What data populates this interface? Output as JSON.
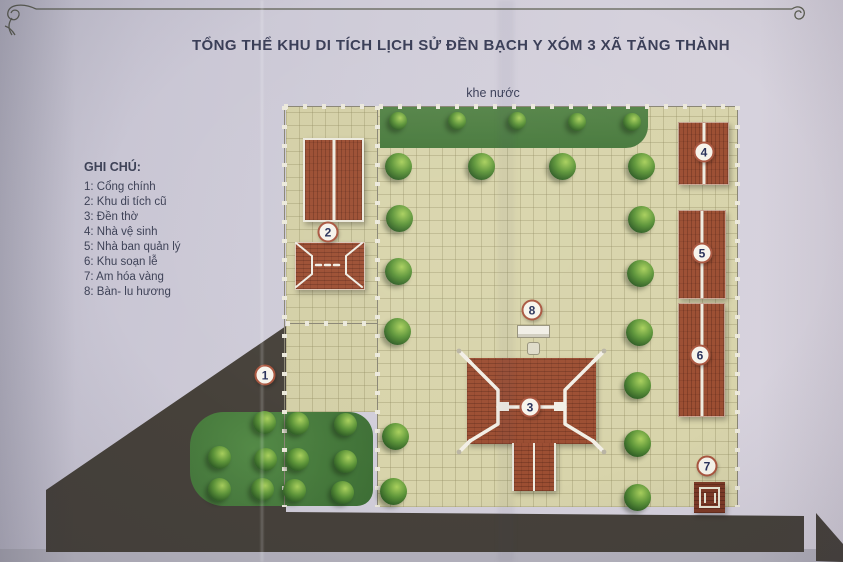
{
  "title": "TỔNG THỂ KHU DI TÍCH LỊCH SỬ ĐỀN BẠCH Y XÓM 3 XÃ TĂNG THÀNH",
  "water_label": "khe nước",
  "legend": {
    "heading": "GHI CHÚ:",
    "items": [
      {
        "num": "1",
        "text": "1: Cổng chính"
      },
      {
        "num": "2",
        "text": "2: Khu di tích cũ"
      },
      {
        "num": "3",
        "text": "3: Đền thờ"
      },
      {
        "num": "4",
        "text": "4: Nhà vệ sinh"
      },
      {
        "num": "5",
        "text": "5: Nhà ban quản lý"
      },
      {
        "num": "6",
        "text": "6: Khu soạn lễ"
      },
      {
        "num": "7",
        "text": "7: Am hóa vàng"
      },
      {
        "num": "8",
        "text": "8: Bàn- lu hương"
      }
    ]
  },
  "markers": [
    "1",
    "2",
    "3",
    "4",
    "5",
    "6",
    "7",
    "8"
  ],
  "colors": {
    "paper": "#cfccd8",
    "courtyard_tile": "#d8d4ab",
    "grass": "#4a7d40",
    "roof": "#9c4e32",
    "road": "#46413a",
    "marker_ring": "#a9563f",
    "marker_number": "#29315a",
    "text": "#3a3e57"
  }
}
